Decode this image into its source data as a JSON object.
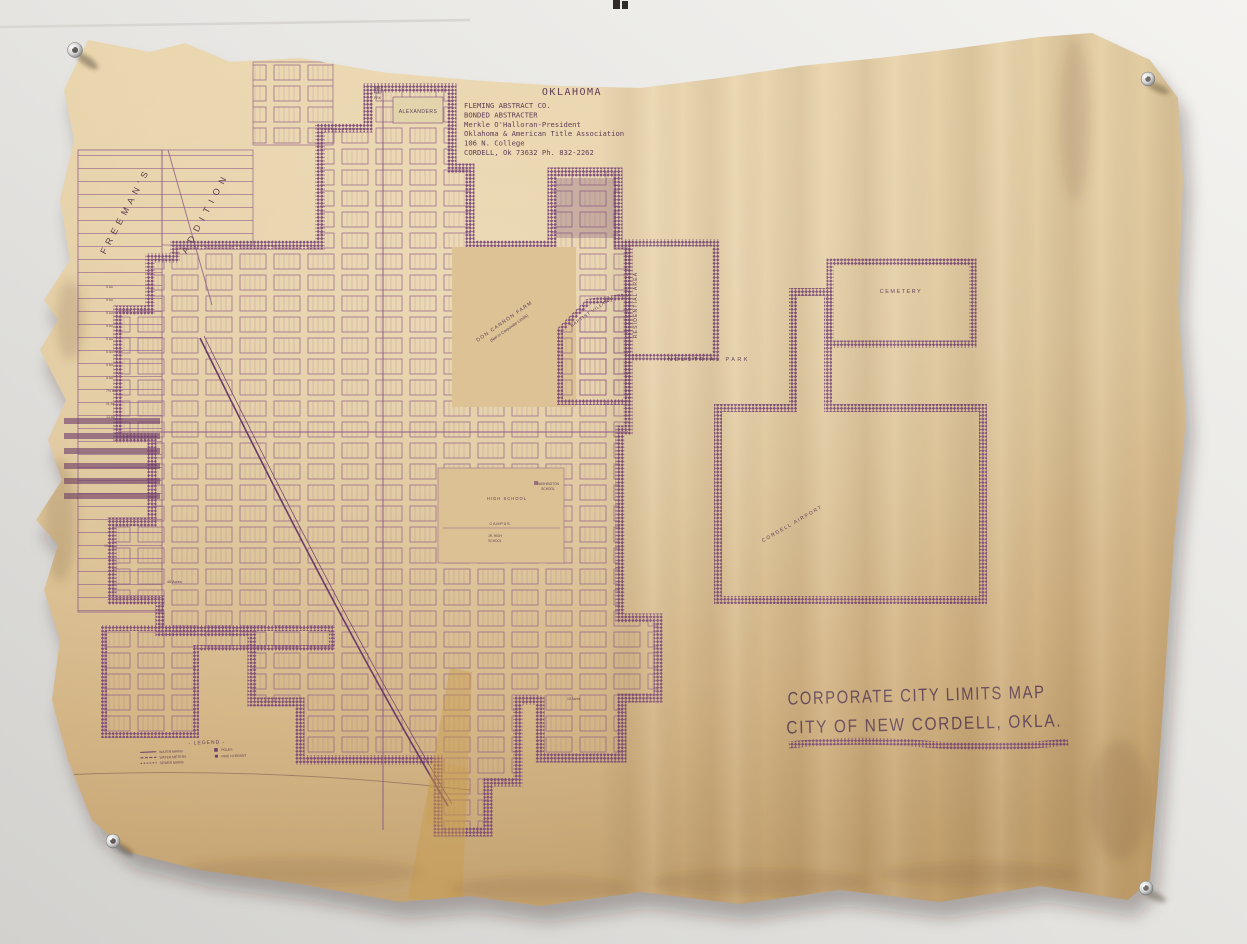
{
  "photo": {
    "wall_color": "#e8e7e4",
    "paper_color": "#d9bd8e",
    "ink_color": "#744672",
    "pencil_color": "#7c5f68",
    "tape_color": "#c89a4a"
  },
  "map": {
    "header": {
      "city_of": "CITY OF",
      "name": "NEW CORDELL",
      "state": "OKLAHOMA"
    },
    "publisher": {
      "lines": [
        "FLEMING ABSTRACT CO.",
        "BONDED ABSTRACTER",
        "Merkle O'Halloran-President",
        "Oklahoma & American Title Association",
        "106 N. College",
        "CORDELL, Ok 73632  Ph. 832-2262"
      ]
    },
    "corner_title": {
      "line1": "CORPORATE CITY LIMITS MAP",
      "line2": "CITY OF NEW CORDELL, OKLA."
    },
    "areas": {
      "cemetery": "CEMETERY",
      "industrial_park": "INDUSTRIAL PARK",
      "residential_area": "RESIDENTIAL AREA",
      "baptist_village": "BAPTIST VILLAGE",
      "don_cannon_farm": "DON CANNON FARM",
      "don_cannon_note": "(Not in Corporate Limits)",
      "cordell_airport": "CORDELL AIRPORT",
      "alexanders": "ALEXANDERS",
      "freemans": "FREEMAN'S",
      "addition": "ADDITION",
      "mhp_1": "MBLE",
      "mhp_2": "HME",
      "mhp_3": "PRK"
    },
    "places": {
      "high_school": "HIGH SCHOOL",
      "washington": "WASHINGTON",
      "washington_school": "SCHOOL",
      "campus": "CAMPUS",
      "jr_high": "JR. HIGH",
      "jr_high_school": "SCHOOL"
    },
    "tracts": {
      "forty_acres": "40 Acres",
      "ten_acres": "10 Acres",
      "acre_rows": [
        "5 Ac",
        "5 Ac",
        "5 Ac",
        "5 Ac",
        "5 Ac",
        "5 Ac",
        "5 Ac",
        "5 Ac",
        "7½ Ac",
        "11 Ac",
        "13 Ac",
        "10 Ac"
      ]
    },
    "legend": {
      "title": "- LEGEND -",
      "entries": [
        "WATER MAINS",
        "WATER METERS",
        "SEWER MAINS",
        "POLES",
        "FIRE HYDRANT"
      ]
    }
  }
}
